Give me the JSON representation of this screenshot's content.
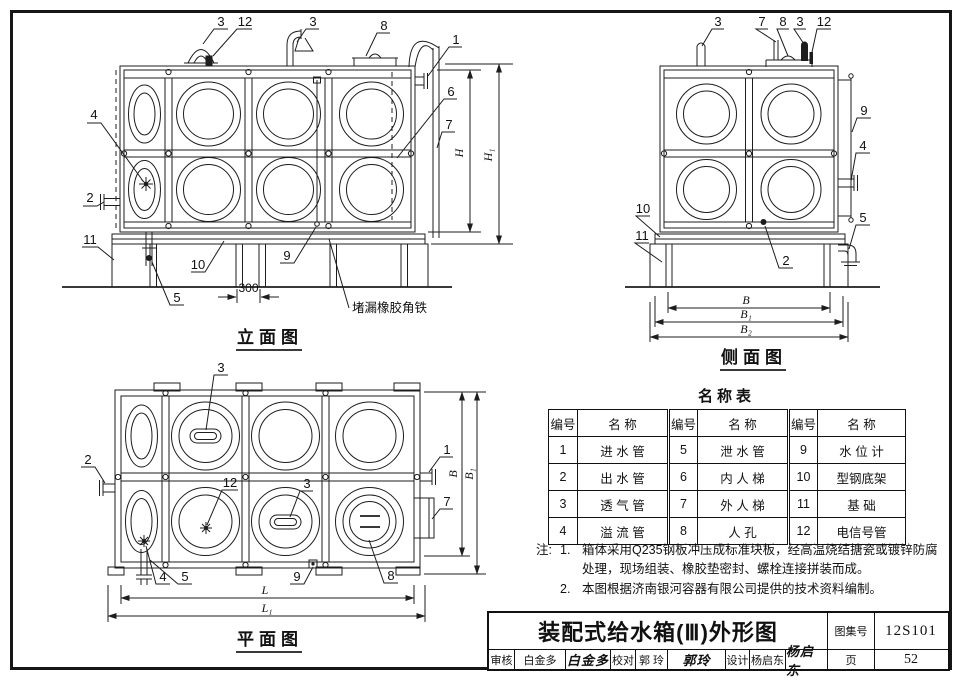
{
  "figure": {
    "elevation": {
      "caption": "立面图",
      "callouts": [
        "3",
        "12",
        "3",
        "8",
        "1",
        "4",
        "6",
        "7",
        "2",
        "11",
        "10",
        "5",
        "9"
      ],
      "annotation": "堵漏橡胶角铁",
      "dim_gap": "300",
      "dim_h": "H",
      "dim_h1": "H₁"
    },
    "side": {
      "caption": "侧面图",
      "callouts": [
        "3",
        "7",
        "8",
        "3",
        "12",
        "9",
        "4",
        "10",
        "11",
        "2",
        "5"
      ],
      "dim_b": "B",
      "dim_b1": "B₁",
      "dim_b2": "B₂"
    },
    "plan": {
      "caption": "平面图",
      "callouts": [
        "3",
        "2",
        "1",
        "12",
        "3",
        "7",
        "4",
        "5",
        "9",
        "8"
      ],
      "dim_b": "B",
      "dim_b1": "B₁",
      "dim_l": "L",
      "dim_l1": "L₁"
    }
  },
  "parts_table": {
    "title": "名称表",
    "headers": [
      "编号",
      "名 称",
      "编号",
      "名 称",
      "编号",
      "名 称"
    ],
    "rows": [
      [
        "1",
        "进 水 管",
        "5",
        "泄 水 管",
        "9",
        "水 位 计"
      ],
      [
        "2",
        "出 水 管",
        "6",
        "内 人 梯",
        "10",
        "型钢底架"
      ],
      [
        "3",
        "透 气 管",
        "7",
        "外 人 梯",
        "11",
        "基  础"
      ],
      [
        "4",
        "溢 流 管",
        "8",
        "人  孔",
        "12",
        "电信号管"
      ]
    ]
  },
  "notes": {
    "prefix": "注:",
    "items": [
      {
        "no": "1.",
        "text": "箱体采用Q235钢板冲压成标准块板，经高温烧结搪瓷或镀锌防腐处理，现场组装、橡胶垫密封、螺栓连接拼装而成。"
      },
      {
        "no": "2.",
        "text": "本图根据济南银河容器有限公司提供的技术资料编制。"
      }
    ]
  },
  "title_block": {
    "title": "装配式给水箱(Ⅲ)外形图",
    "atlas_label": "图集号",
    "atlas_value": "12S101",
    "page_label": "页",
    "page_value": "52",
    "approvals": [
      {
        "role": "审核",
        "name": "白金多",
        "sig": "白金多"
      },
      {
        "role": "校对",
        "name": "郭 玲",
        "sig": "郭玲"
      },
      {
        "role": "设计",
        "name": "杨启东",
        "sig": "杨启东"
      }
    ]
  }
}
